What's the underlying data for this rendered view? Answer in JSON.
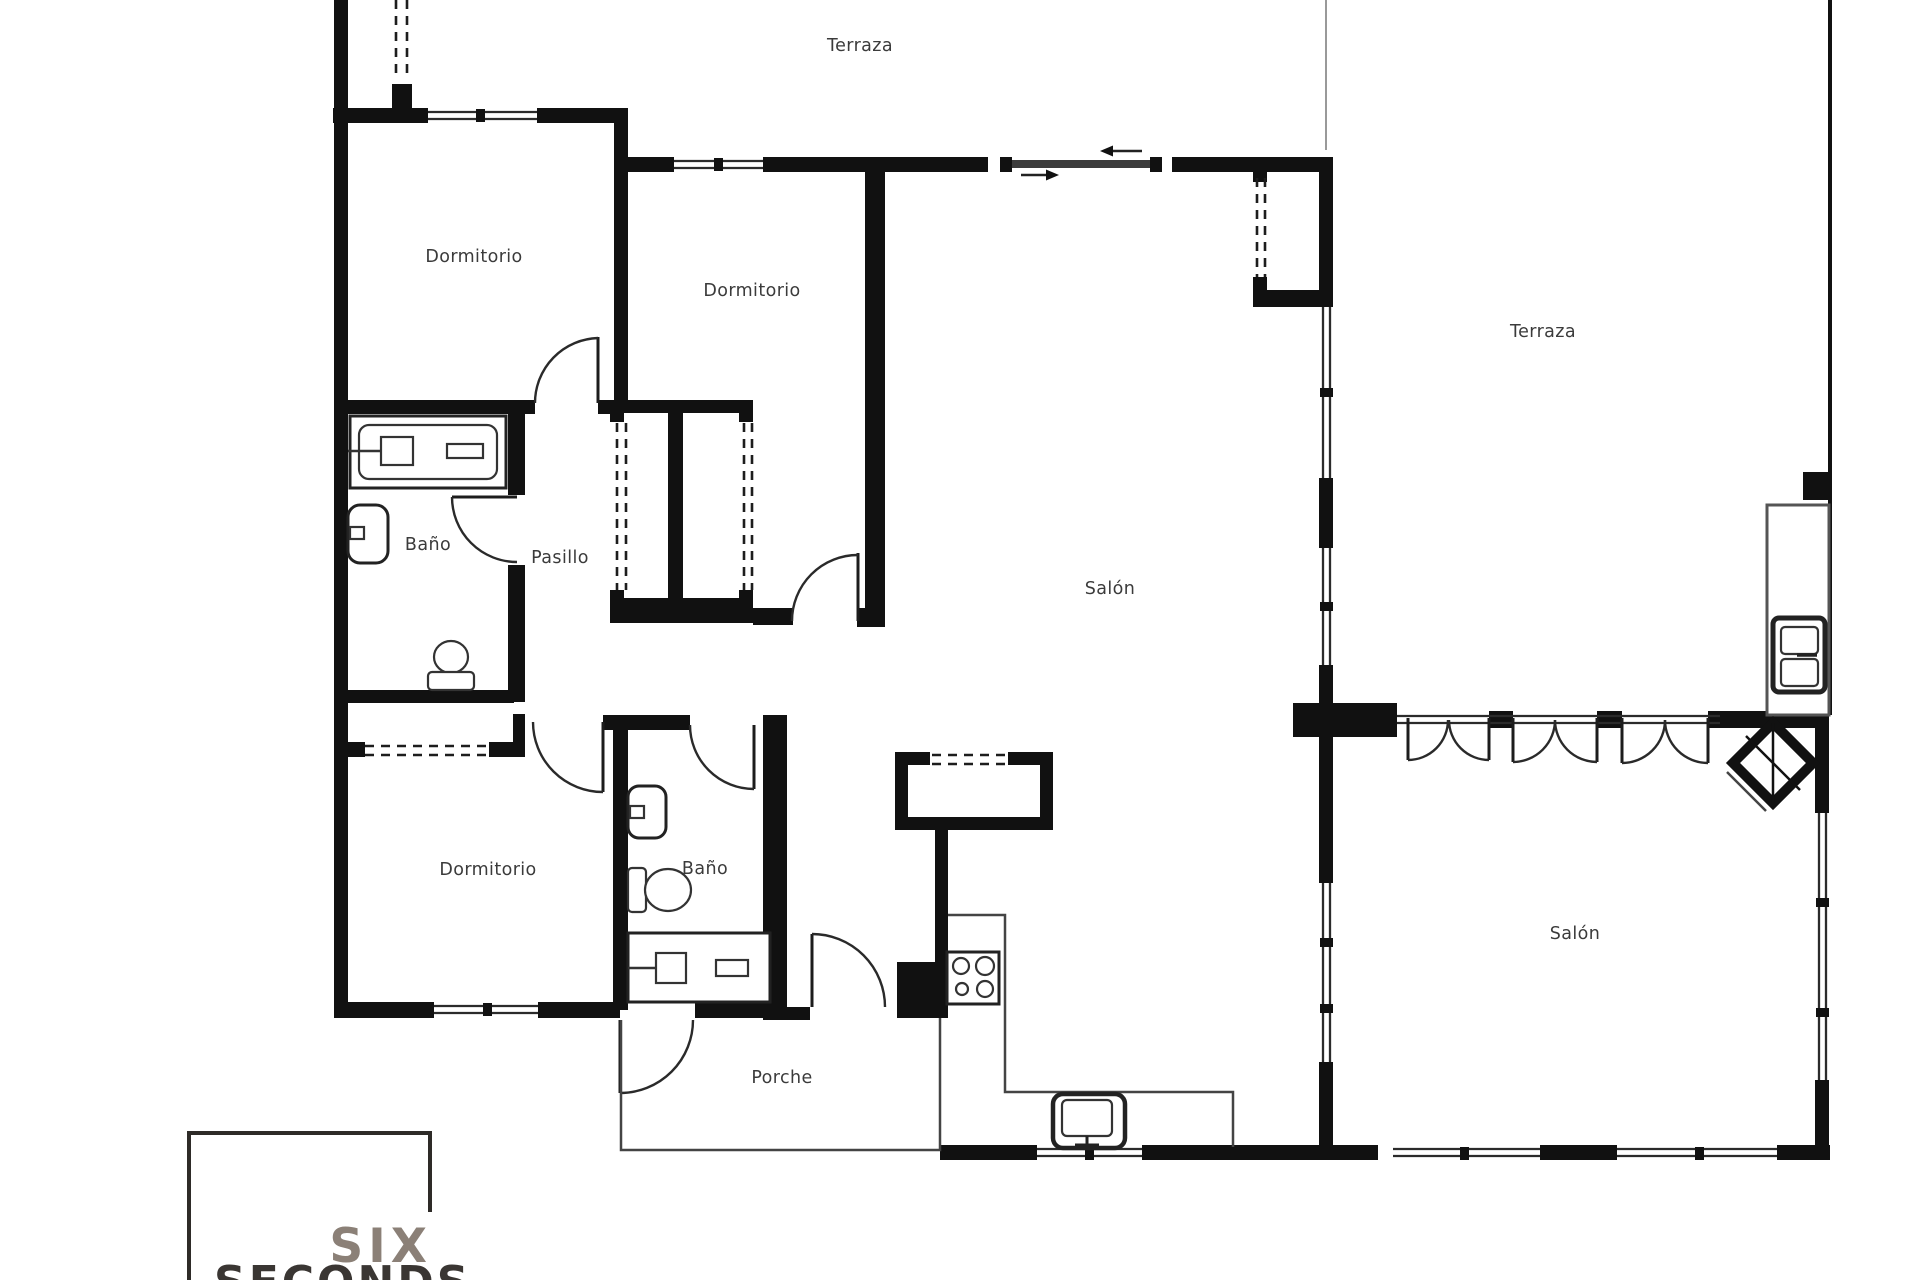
{
  "rooms": {
    "terraza_top": {
      "label": "Terraza"
    },
    "dormitorio_1": {
      "label": "Dormitorio"
    },
    "dormitorio_2": {
      "label": "Dormitorio"
    },
    "terraza_right": {
      "label": "Terraza"
    },
    "bano_1": {
      "label": "Baño"
    },
    "pasillo": {
      "label": "Pasillo"
    },
    "salon_main": {
      "label": "Salón"
    },
    "dormitorio_3": {
      "label": "Dormitorio"
    },
    "bano_2": {
      "label": "Baño"
    },
    "salon_right": {
      "label": "Salón"
    },
    "porche": {
      "label": "Porche"
    }
  },
  "logo": {
    "line1": "SIX",
    "line2": "SECONDS"
  },
  "colors": {
    "wall": "#111111",
    "label": "#3b3b3b",
    "logo_six": "#8b8077",
    "logo_seconds": "#3a3633",
    "background": "#ffffff"
  }
}
